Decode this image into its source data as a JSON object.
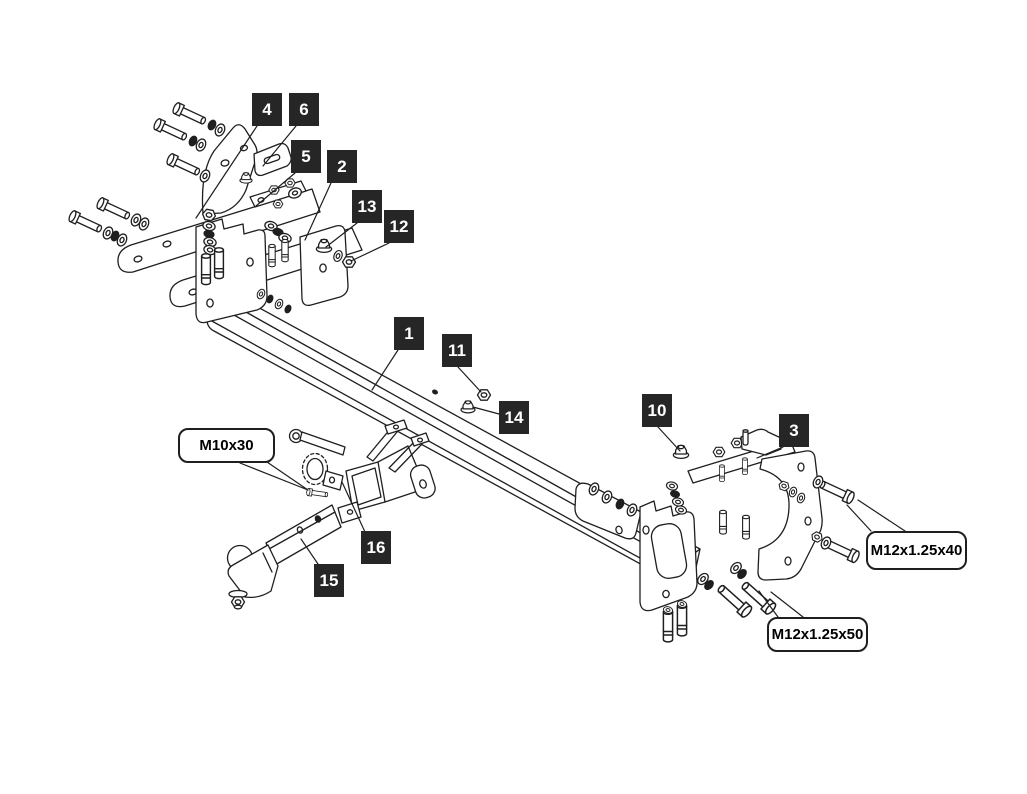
{
  "canvas": {
    "width": 1027,
    "height": 794
  },
  "colors": {
    "background": "#ffffff",
    "line_art": "#1f1f1f",
    "callout_background": "#262626",
    "callout_text": "#ffffff",
    "spec_label_background": "#ffffff",
    "spec_label_border": "#1f1f1f",
    "spec_label_text": "#000000"
  },
  "callouts": {
    "items": [
      {
        "number": "1"
      },
      {
        "number": "2"
      },
      {
        "number": "3"
      },
      {
        "number": "4"
      },
      {
        "number": "5"
      },
      {
        "number": "6"
      },
      {
        "number": "10"
      },
      {
        "number": "11"
      },
      {
        "number": "12"
      },
      {
        "number": "13"
      },
      {
        "number": "14"
      },
      {
        "number": "15"
      },
      {
        "number": "16"
      }
    ]
  },
  "spec_labels": {
    "items": [
      {
        "text": "M10x30"
      },
      {
        "text": "M12x1.25x40"
      },
      {
        "text": "M12x1.25x50"
      }
    ]
  }
}
